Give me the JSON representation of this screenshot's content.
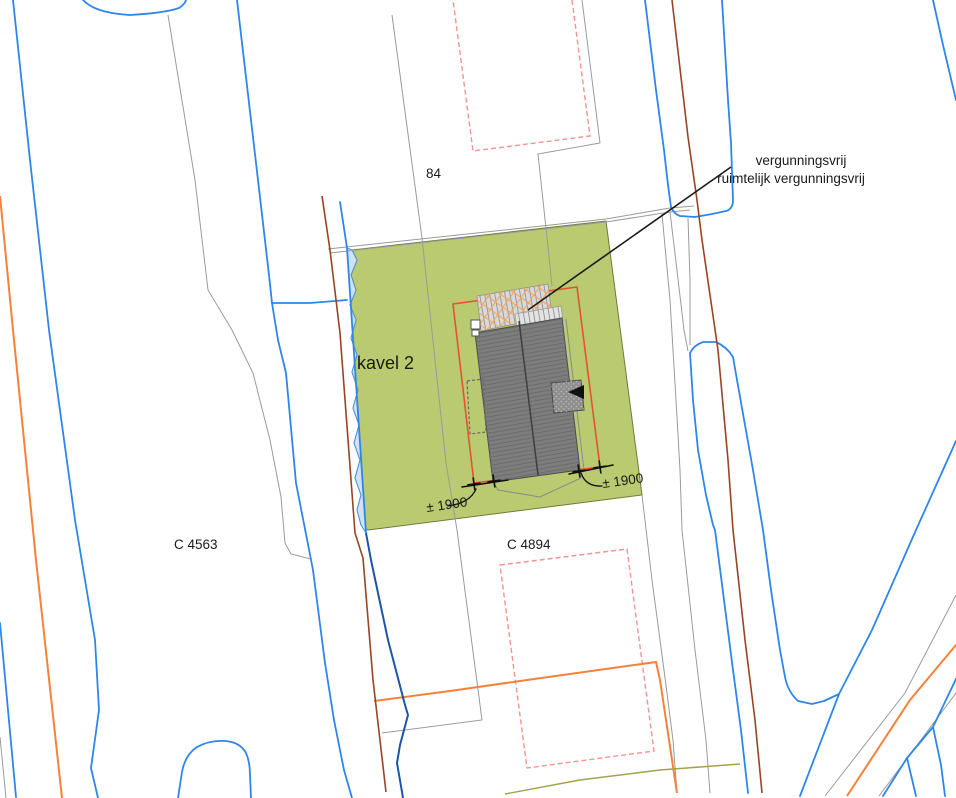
{
  "map": {
    "title": "site-plan",
    "labels": {
      "parcel_left": "C 4563",
      "parcel_right": "C 4894",
      "house_number": "84",
      "plot": "kavel 2",
      "dimension_left": "± 1900",
      "dimension_right": "± 1900",
      "annotation_line1": "vergunningsvrij",
      "annotation_line2": "ruimtelijk vergunningsvrij"
    },
    "colors": {
      "plot_fill_green": "#b9ca70",
      "water_fill": "#cfe3f5",
      "water_line_blue": "#2e86ec",
      "ditch_navy": "#1c55a8",
      "building_gray": "#7d7d7d",
      "roof_hatch_gray": "#d9d9d9",
      "envelope_red_orange": "#e8512f",
      "boundary_pink": "#f29490",
      "road_orange": "#f5813a",
      "maroon_line": "#9a4422",
      "parcel_gray": "#9a9a9a",
      "olive_line": "#a3a14e",
      "annotation_black": "#1a1a1a"
    }
  }
}
